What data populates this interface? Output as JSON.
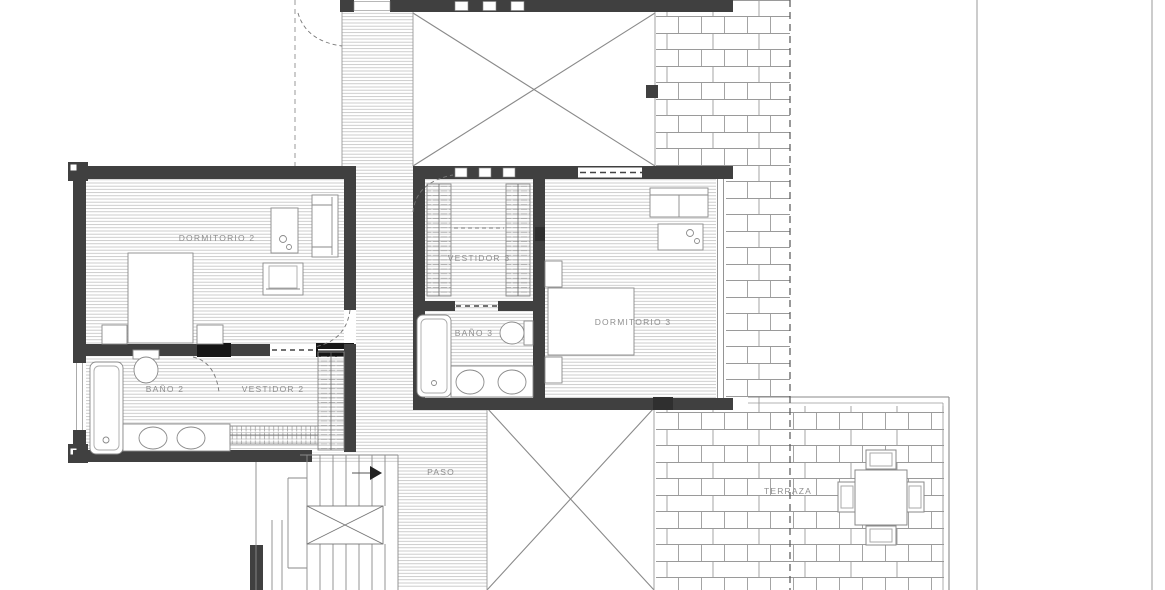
{
  "rooms": [
    {
      "id": "dormitorio-2",
      "label": "DORMITORIO 2"
    },
    {
      "id": "vestidor-3",
      "label": "VESTIDOR 3"
    },
    {
      "id": "bano-3",
      "label": "BAÑO 3"
    },
    {
      "id": "dormitorio-3",
      "label": "DORMITORIO 3"
    },
    {
      "id": "bano-2",
      "label": "BAÑO 2"
    },
    {
      "id": "vestidor-2",
      "label": "VESTIDOR 2"
    },
    {
      "id": "paso",
      "label": "PASO"
    },
    {
      "id": "terraza",
      "label": "TERRAZA"
    }
  ],
  "colors": {
    "wall": "#404040",
    "bold_fitment": "#161616",
    "thin_line": "#8a8a8a",
    "hatch_line": "#bcbcbc",
    "brick_line": "#9a9a9a",
    "label_text": "#8f8f8f",
    "background": "#ffffff"
  }
}
